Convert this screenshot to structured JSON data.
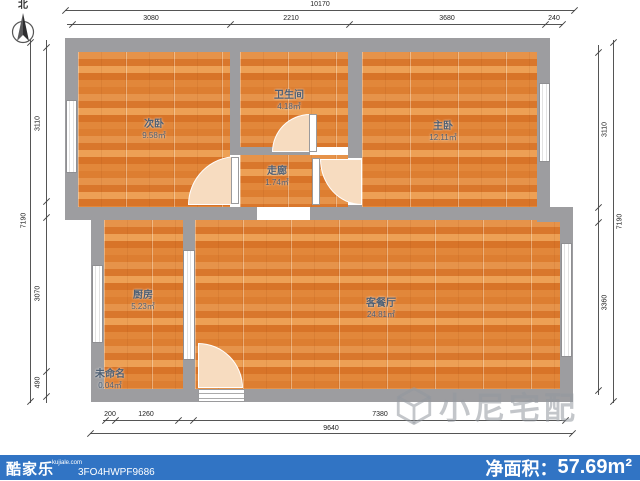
{
  "north": {
    "label": "北"
  },
  "rooms": [
    {
      "name": "次卧",
      "area": "9.58㎡"
    },
    {
      "name": "卫生间",
      "area": "4.18㎡"
    },
    {
      "name": "主卧",
      "area": "12.11㎡"
    },
    {
      "name": "走廊",
      "area": "1.74㎡"
    },
    {
      "name": "厨房",
      "area": "5.23㎡"
    },
    {
      "name": "客餐厅",
      "area": "24.81㎡"
    },
    {
      "name": "未命名",
      "area": "0.04㎡"
    }
  ],
  "dimensions": {
    "top": {
      "total": "10170",
      "segments": [
        "3080",
        "2210",
        "3680",
        "240"
      ]
    },
    "left": {
      "total": "7190",
      "segments": [
        "3110",
        "3070",
        "490"
      ]
    },
    "right": {
      "total": "7190",
      "segments": [
        "3110",
        "3360"
      ]
    },
    "bottom": {
      "total": "9640",
      "segments": [
        "200",
        "1260",
        "7380"
      ]
    }
  },
  "watermark": {
    "text": "小尼宅配"
  },
  "footer": {
    "brand": "酷家乐",
    "brand_domain": "kujiale.com",
    "code": "3FO4HWPF9686",
    "area_label": "净面积：",
    "area_value": "57.69m²"
  },
  "colors": {
    "wall": "#9d9da0",
    "floor_base": "#dd8038",
    "footer_bar": "#3174c4",
    "door_arc": "#f7dcc0"
  }
}
